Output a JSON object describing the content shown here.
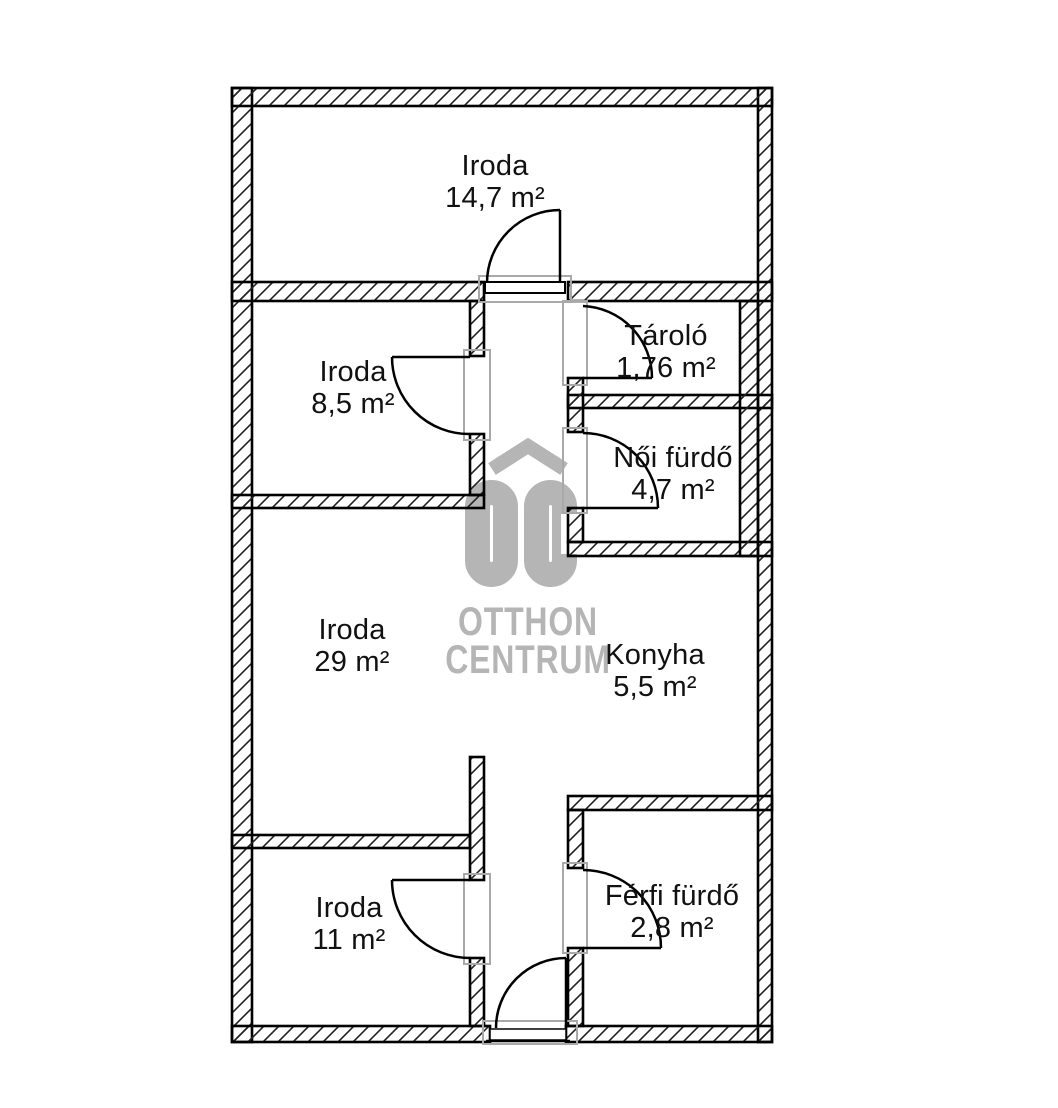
{
  "watermark": {
    "initials": "OC",
    "line1": "OTTHON",
    "line2": "CENTRUM",
    "color": "#b5b5b5"
  },
  "rooms": [
    {
      "id": "iroda-top",
      "name": "Iroda",
      "area": "14,7 m²"
    },
    {
      "id": "iroda-85",
      "name": "Iroda",
      "area": "8,5 m²"
    },
    {
      "id": "tarolo",
      "name": "Tároló",
      "area": "1,76 m²"
    },
    {
      "id": "noi-furdo",
      "name": "Női fürdő",
      "area": "4,7 m²"
    },
    {
      "id": "iroda-29",
      "name": "Iroda",
      "area": "29 m²"
    },
    {
      "id": "konyha",
      "name": "Konyha",
      "area": "5,5 m²"
    },
    {
      "id": "iroda-11",
      "name": "Iroda",
      "area": "11 m²"
    },
    {
      "id": "ferfi-furdo",
      "name": "Férfi fürdő",
      "area": "2,8 m²"
    }
  ],
  "colors": {
    "background": "#ffffff",
    "wall_line": "#000000",
    "hatch_line": "#222222",
    "door_jamb": "#a9a9a9",
    "watermark": "#b5b5b5",
    "label_text": "#111111"
  }
}
